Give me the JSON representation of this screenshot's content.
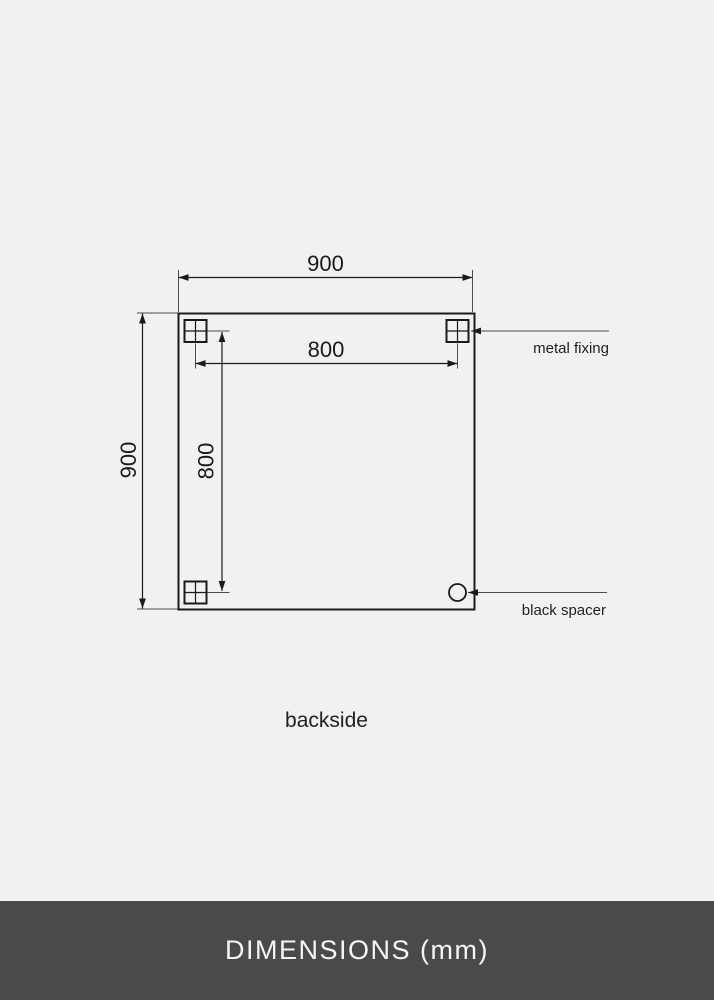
{
  "drawing": {
    "caption": "backside",
    "dim_width_total": "900",
    "dim_height_total": "900",
    "dim_fixing_width": "800",
    "dim_fixing_height": "800",
    "annotations": {
      "metal_fixing": "metal fixing",
      "black_spacer": "black spacer"
    },
    "units": "mm"
  },
  "footer": {
    "title": "DIMENSIONS (mm)"
  },
  "colors": {
    "background": "#F1F1F2",
    "line": "#1A1A1A",
    "thin_line": "#4D4D4D",
    "footer_background": "#4A4A4A",
    "footer_text": "#F5F5F5"
  }
}
